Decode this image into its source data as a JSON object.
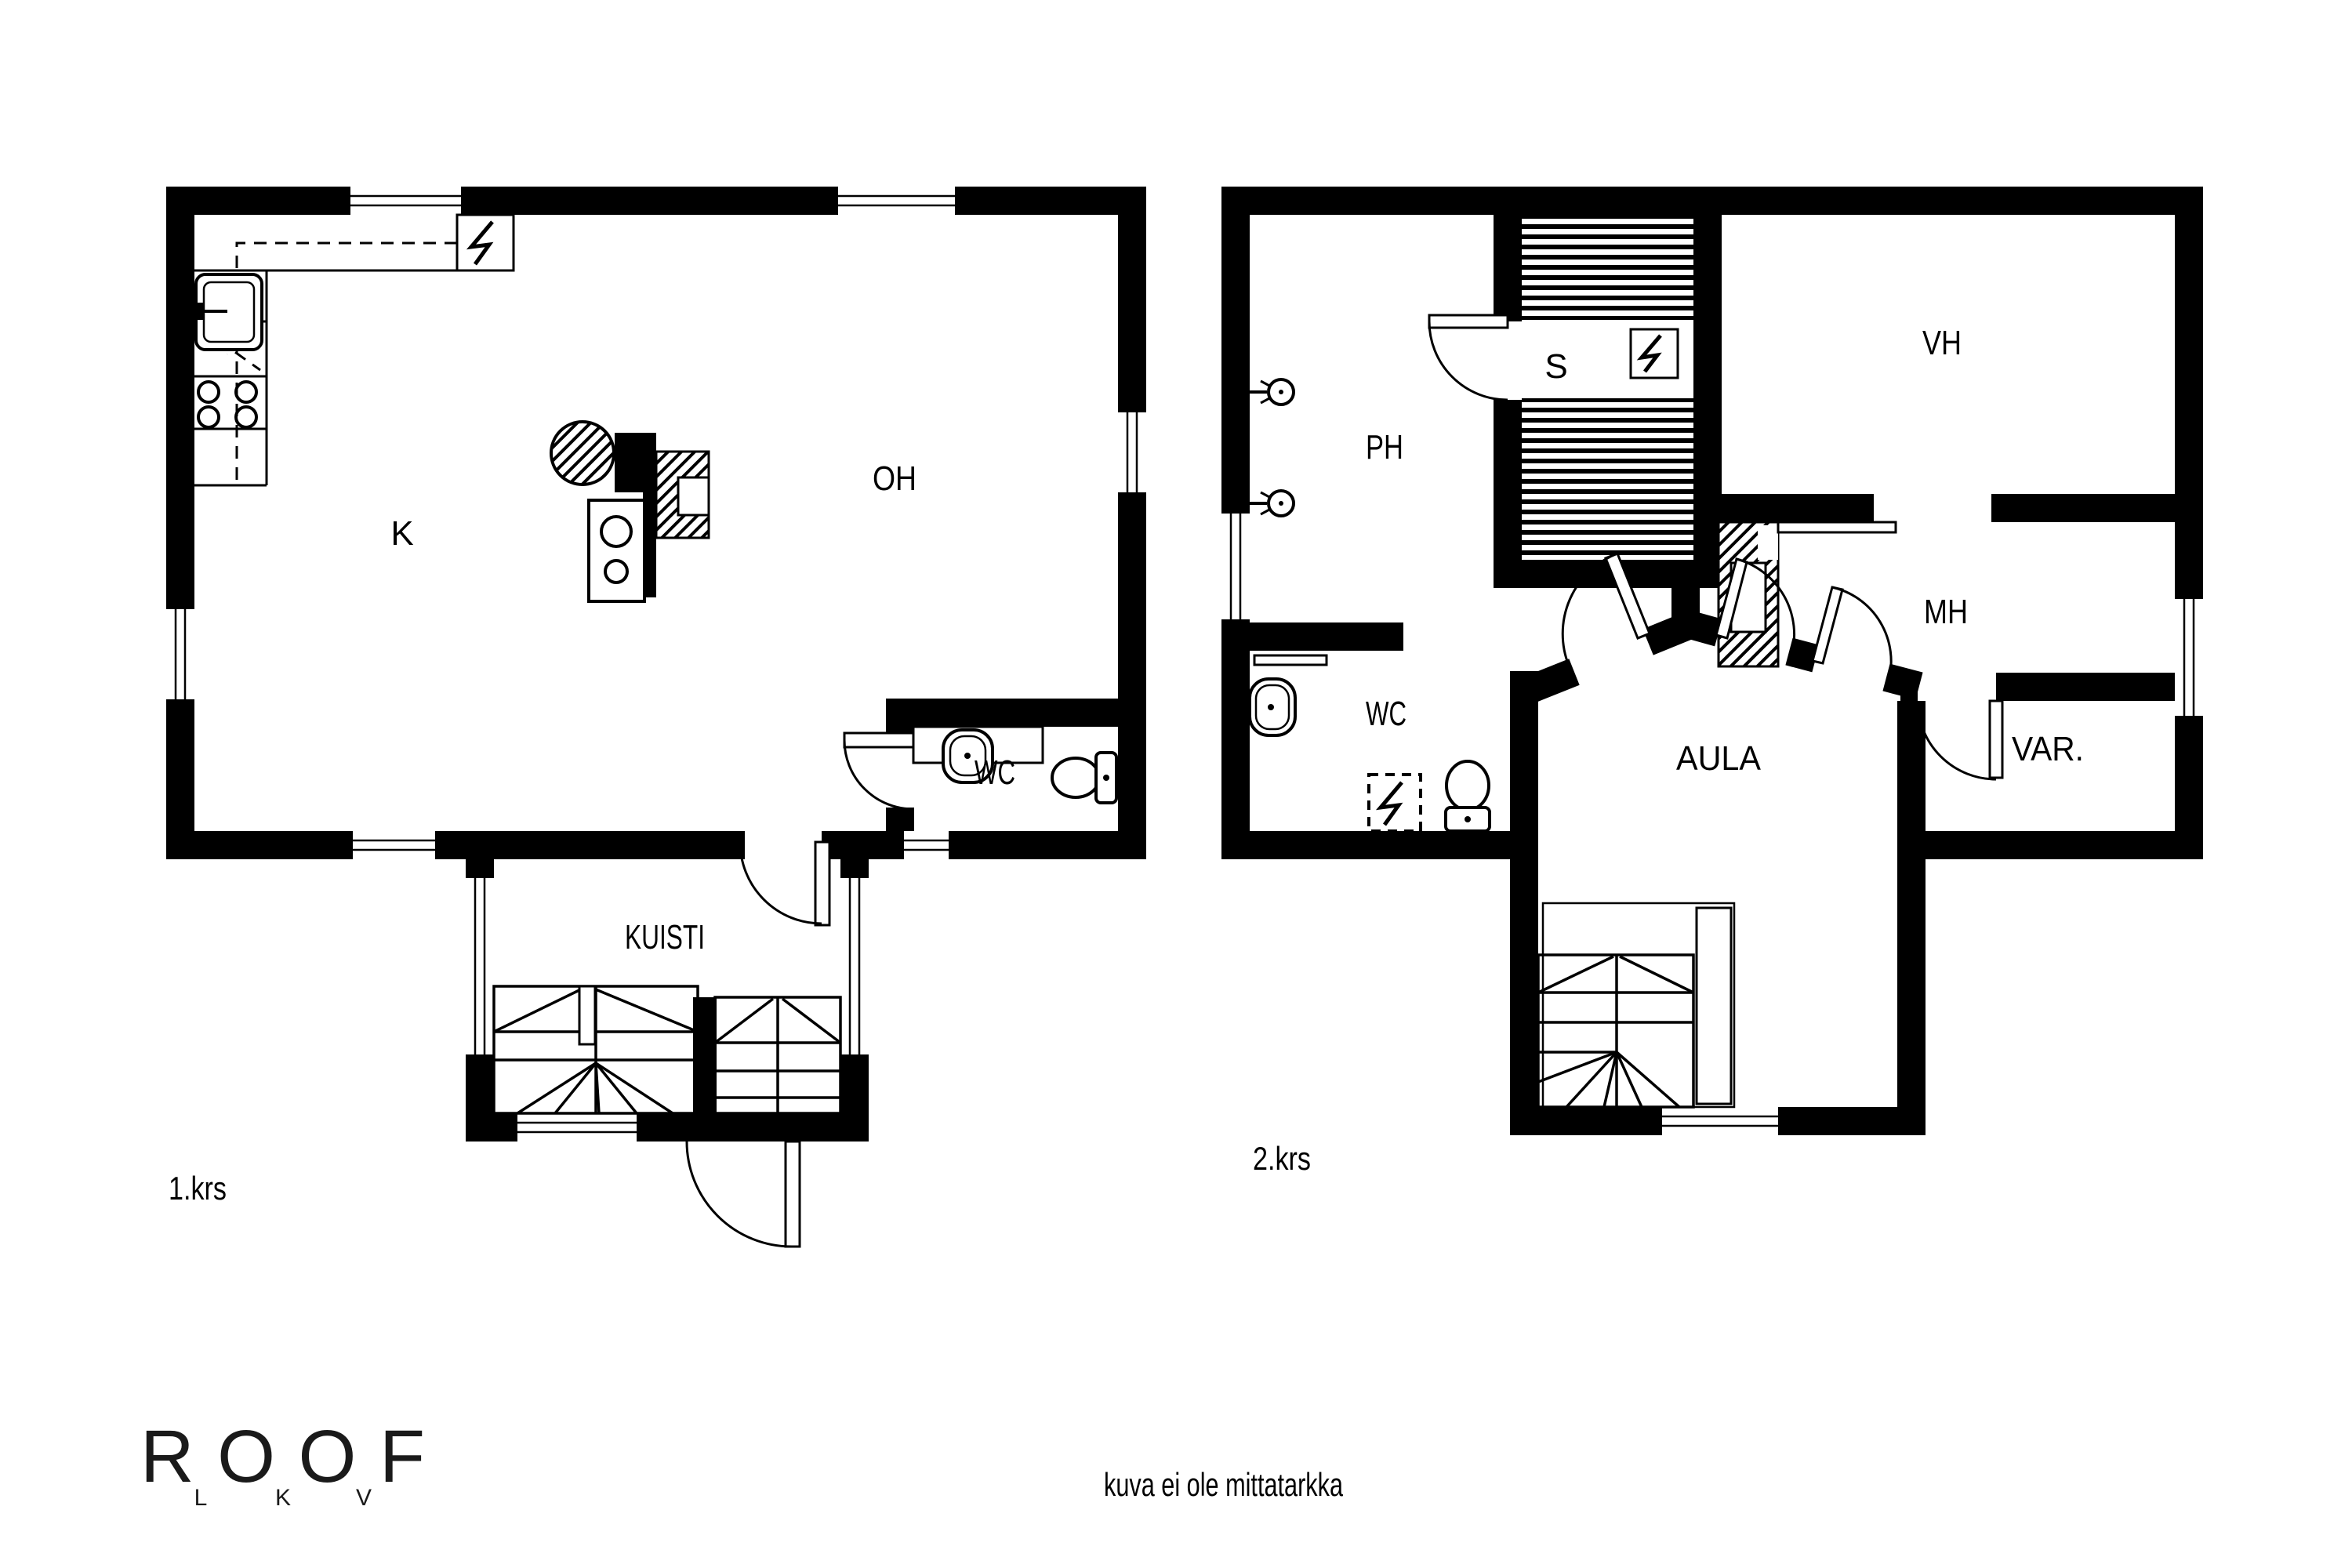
{
  "document": {
    "disclaimer": "kuva ei ole mittatarkka"
  },
  "logo": {
    "text": "ROOF",
    "sub_letters": [
      "L",
      "K",
      "V"
    ]
  },
  "colors": {
    "ink": "#000000",
    "paper": "#ffffff"
  },
  "icons": {
    "electrical_panel": "lightning-bolt",
    "sauna_stove": "lightning-bolt",
    "appliance_reservation": "lightning-bolt-dashed",
    "shower": "shower-head",
    "toilet": "toilet-seat",
    "sink": "wash-basin"
  },
  "floors": [
    {
      "label": "1.krs",
      "rooms": [
        {
          "name": "K"
        },
        {
          "name": "OH"
        },
        {
          "name": "WC"
        },
        {
          "name": "KUISTI"
        }
      ]
    },
    {
      "label": "2.krs",
      "rooms": [
        {
          "name": "PH"
        },
        {
          "name": "S"
        },
        {
          "name": "VH"
        },
        {
          "name": "MH"
        },
        {
          "name": "WC"
        },
        {
          "name": "AULA"
        },
        {
          "name": "VAR."
        }
      ]
    }
  ]
}
